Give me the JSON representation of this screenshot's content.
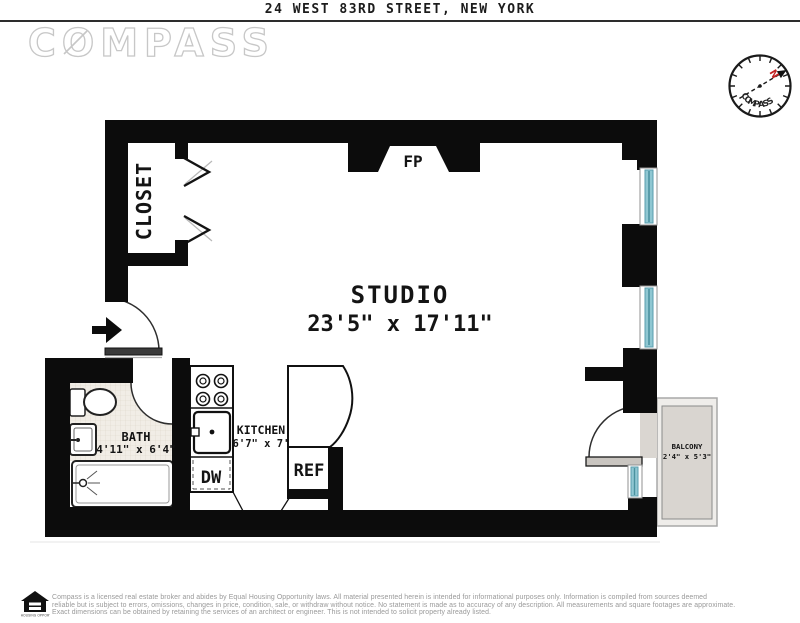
{
  "header": {
    "address": "24 WEST 83RD STREET, NEW YORK",
    "brand": "COMPASS"
  },
  "compass_rose": {
    "label": "COMPASS",
    "north": "N"
  },
  "plan": {
    "studio": {
      "name": "STUDIO",
      "dims": "23'5\" x 17'11\""
    },
    "closet": {
      "name": "CLOSET"
    },
    "bath": {
      "name": "BATH",
      "dims": "4'11\" x 6'4\""
    },
    "kitchen": {
      "name": "KITCHEN",
      "dims": "6'7\" x 7'"
    },
    "balcony": {
      "name": "BALCONY",
      "dims": "2'4\" x 5'3\""
    },
    "fireplace": "FP",
    "dishwasher": "DW",
    "refrigerator": "REF"
  },
  "footer": {
    "equal_housing": "EQUAL HOUSING OPPORTUNITY",
    "lines": [
      "Compass is a licensed real estate broker and abides by Equal Housing Opportunity laws. All material presented herein is intended for informational purposes only. Information is compiled from sources deemed",
      "reliable but is subject to errors, omissions, changes in price, condition, sale, or withdraw without notice. No statement is made as to accuracy of any description. All measurements and square footages are approximate.",
      "Exact dimensions can be obtained by retaining the services of an architect or engineer. This is not intended to solicit property already listed."
    ]
  },
  "colors": {
    "wall": "#0c0c0c",
    "window_glass": "#8fc7d2",
    "balcony_floor": "#d9d5d0",
    "tile": "#f1ede6",
    "north_red": "#c22222"
  }
}
